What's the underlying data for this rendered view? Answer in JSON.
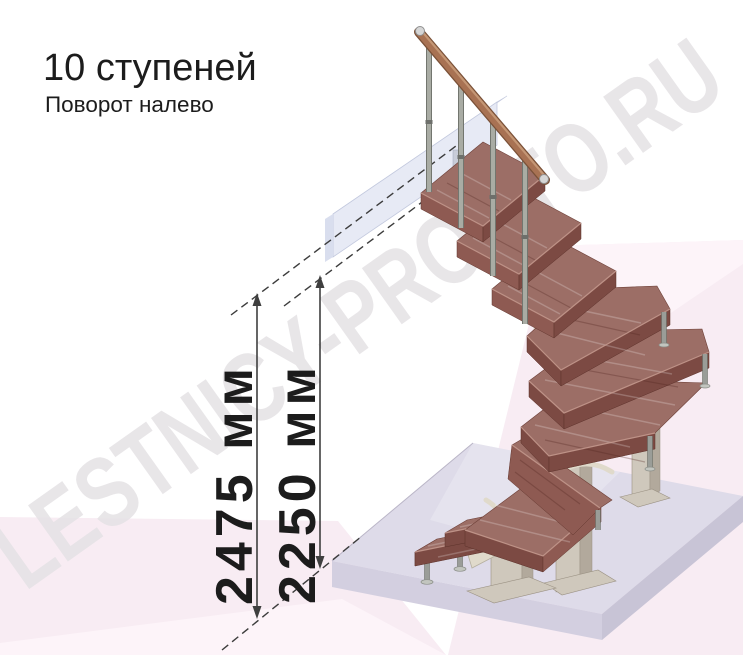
{
  "header": {
    "title": "10 ступеней",
    "subtitle": "Поворот налево"
  },
  "watermark": "LESTNICY-PROSTO.RU",
  "dimensions": [
    {
      "id": "height-total",
      "label": "2475 мм",
      "value_mm": 2475
    },
    {
      "id": "height-floor-to-landing",
      "label": "2250 мм",
      "value_mm": 2250
    }
  ],
  "staircase": {
    "steps": 10,
    "turn": "налево",
    "materials": {
      "treads": "wood",
      "frame": "metal",
      "handrail": "wood"
    }
  },
  "colors": {
    "text": "#1c1c1c",
    "watermark": "#e5e2e5",
    "pink": "#f8ecf3",
    "pink_light": "#fdf4f9",
    "wood_top": "#9c6e66",
    "wood_side": "#8e5a52",
    "wood_front": "#7c4a43",
    "wood_light": "#c59a8f",
    "handrail": "#a87253",
    "handrail_light": "#c49674",
    "handrail_dark": "#7a5138",
    "metal": "#a9aca4",
    "column": "#cfc8bc",
    "column_side": "#b2a99c",
    "bracket": "#e0dacb",
    "floor_top": "#dedbe9",
    "floor_left": "#d3cfe0",
    "floor_right": "#c8c4d6",
    "slab_front": "#e7eaf5",
    "slab_top": "#f2f4fa",
    "slab_end": "#d9deee",
    "dim": "#3f3f3f"
  }
}
